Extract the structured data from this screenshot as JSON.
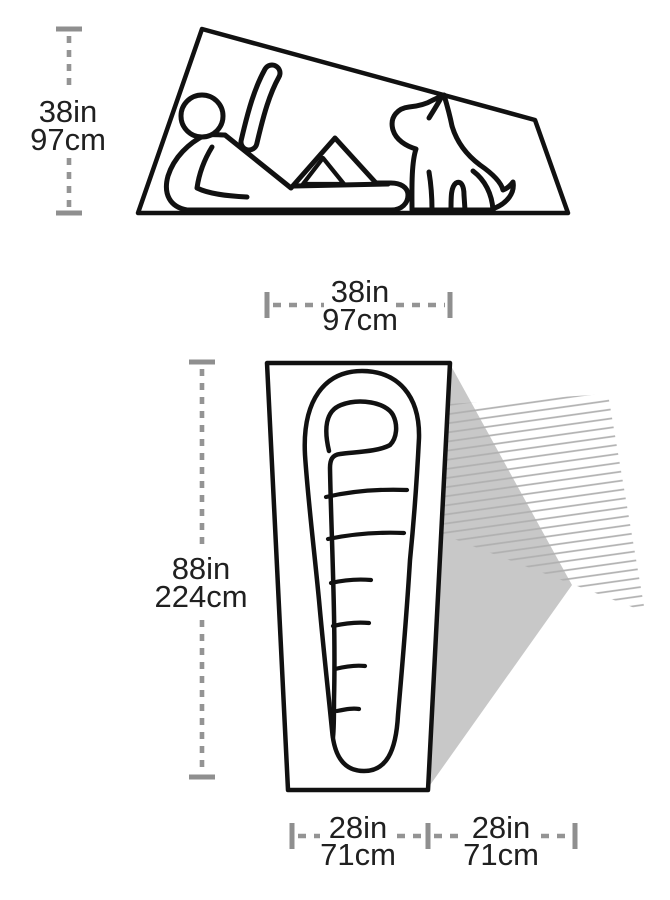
{
  "side_view": {
    "height_label": {
      "in": "38in",
      "cm": "97cm"
    },
    "figures": {
      "person": "reclining-person-icon",
      "dog": "sitting-dog-icon"
    }
  },
  "floor_plan": {
    "width_label": {
      "in": "38in",
      "cm": "97cm"
    },
    "length_label": {
      "in": "88in",
      "cm": "224cm"
    },
    "floor_width_label": {
      "in": "28in",
      "cm": "71cm"
    },
    "vestibule_width_label": {
      "in": "28in",
      "cm": "71cm"
    }
  },
  "colors": {
    "outline": "#111111",
    "dimension_line": "#949494",
    "label_text": "#202020",
    "vestibule_fill": "#c8c8c8",
    "hatch_line": "#b0b0b0",
    "background": "#ffffff"
  }
}
